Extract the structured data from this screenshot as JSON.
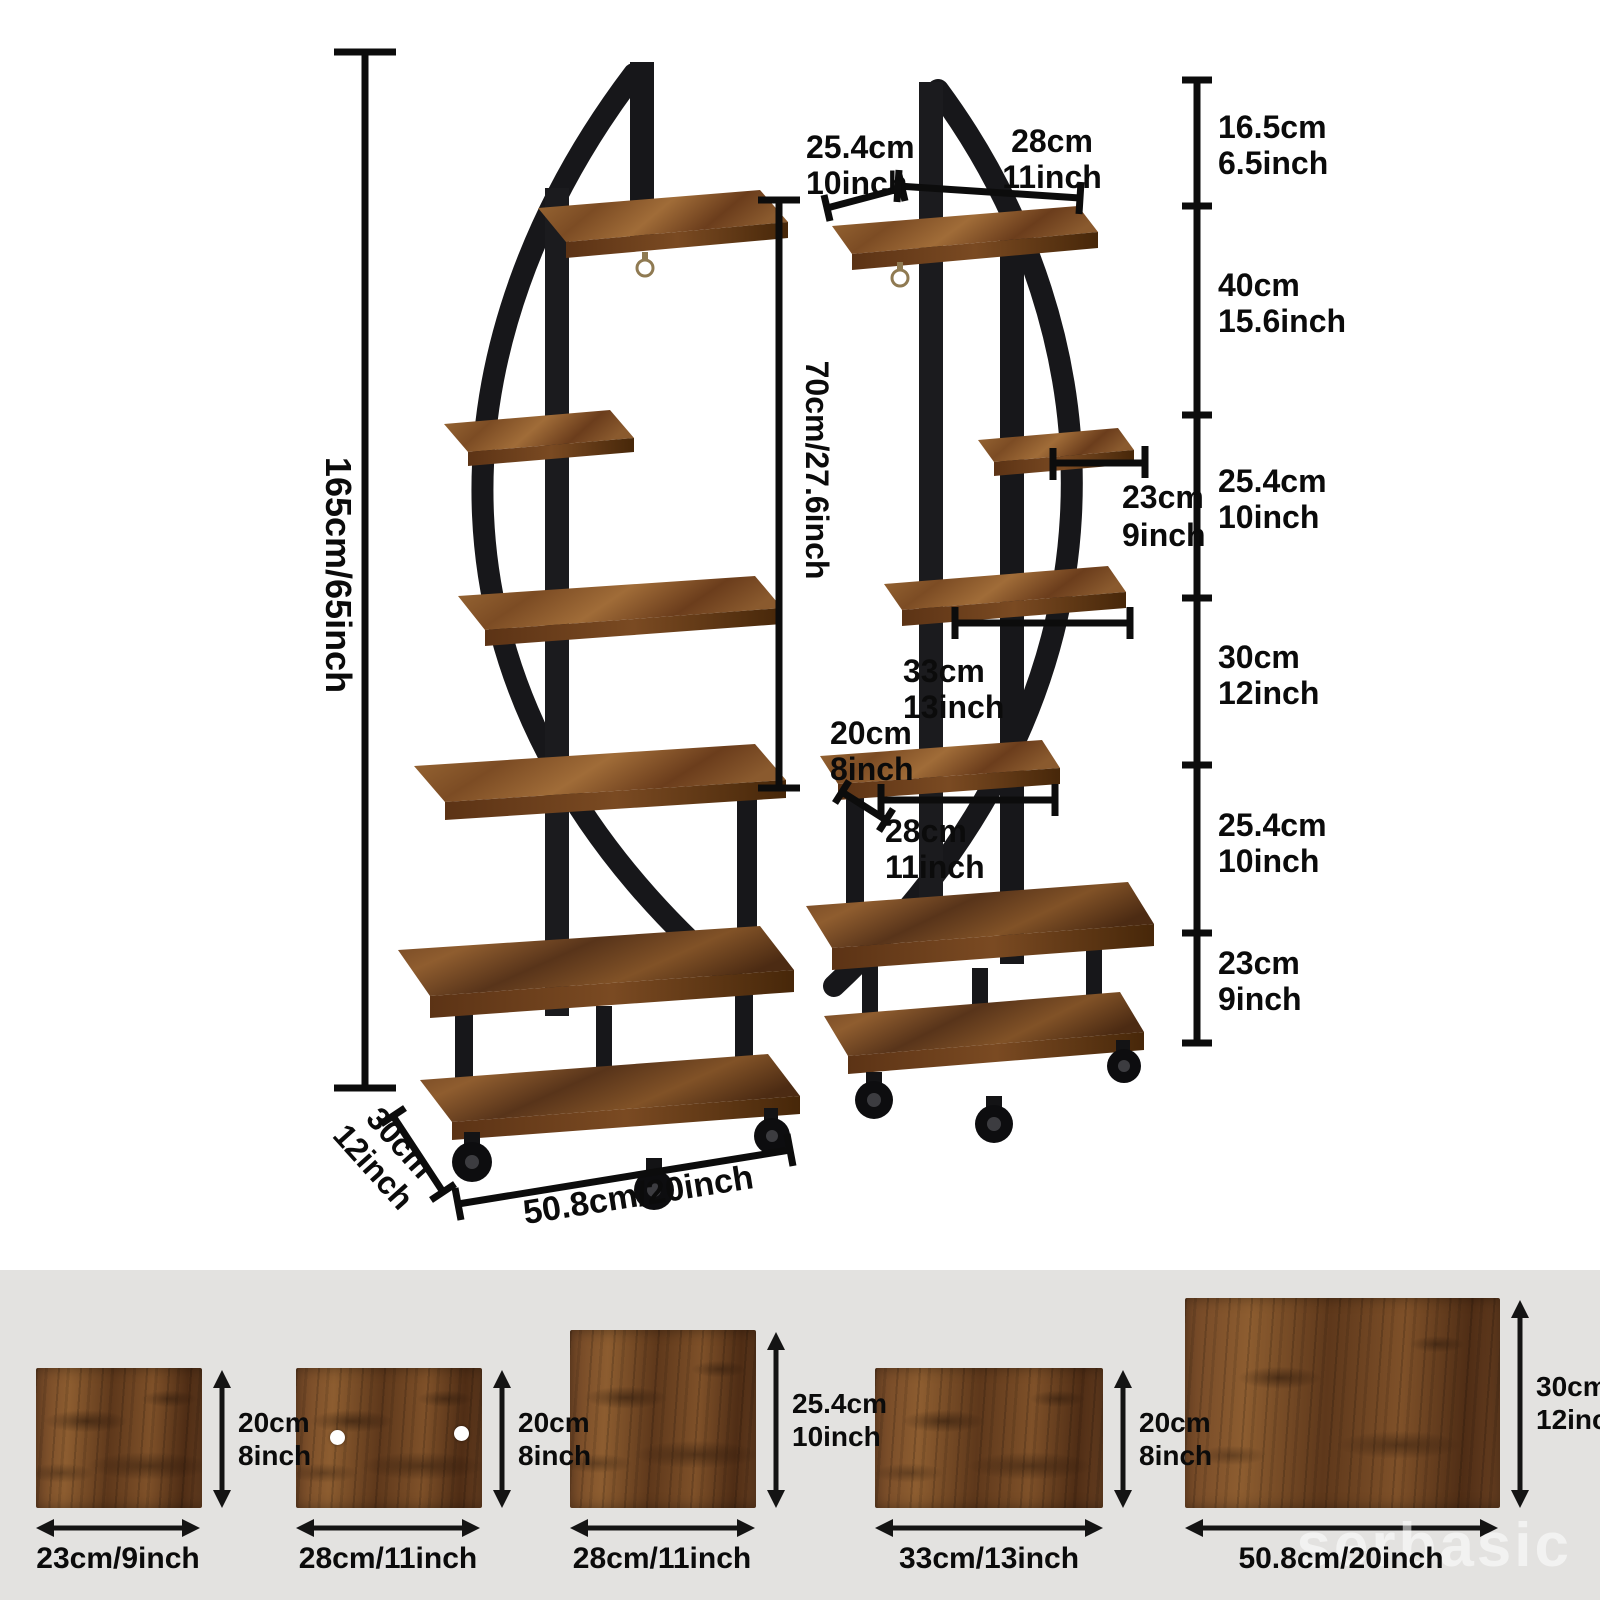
{
  "colors": {
    "background_top": "#ffffff",
    "background_panel": "#e3e2e0",
    "metal_frame": "#17171a",
    "wood_mid": "#8a5a2e",
    "dimension_lines": "#0c0c0c",
    "watermark_text": "rgba(255,255,255,0.55)"
  },
  "stands": {
    "left": {
      "overall_height": "165cm/65inch",
      "inner_height": "70cm/27.6inch",
      "base_depth": [
        "30cm",
        "12inch"
      ],
      "base_width": "50.8cm/20inch"
    },
    "right": {
      "top_shelf_depth": [
        "25.4cm",
        "10inch"
      ],
      "top_shelf_width": [
        "28cm",
        "11inch"
      ],
      "tier2_shelf_depth": [
        "23cm",
        "9inch"
      ],
      "tier3_shelf_width": [
        "33cm",
        "13inch"
      ],
      "tier4_shelf_depth": [
        "20cm",
        "8inch"
      ],
      "tier4_shelf_width": [
        "28cm",
        "11inch"
      ]
    },
    "height_segments": [
      [
        "16.5cm",
        "6.5inch"
      ],
      [
        "40cm",
        "15.6inch"
      ],
      [
        "25.4cm",
        "10inch"
      ],
      [
        "30cm",
        "12inch"
      ],
      [
        "25.4cm",
        "10inch"
      ],
      [
        "23cm",
        "9inch"
      ]
    ]
  },
  "boards": [
    {
      "width": "23cm/9inch",
      "height": [
        "20cm",
        "8inch"
      ]
    },
    {
      "width": "28cm/11inch",
      "height": [
        "20cm",
        "8inch"
      ]
    },
    {
      "width": "28cm/11inch",
      "height": [
        "25.4cm",
        "10inch"
      ]
    },
    {
      "width": "33cm/13inch",
      "height": [
        "20cm",
        "8inch"
      ]
    },
    {
      "width": "50.8cm/20inch",
      "height": [
        "30cm",
        "12inch"
      ]
    }
  ],
  "watermark": {
    "text": "serbasic"
  }
}
